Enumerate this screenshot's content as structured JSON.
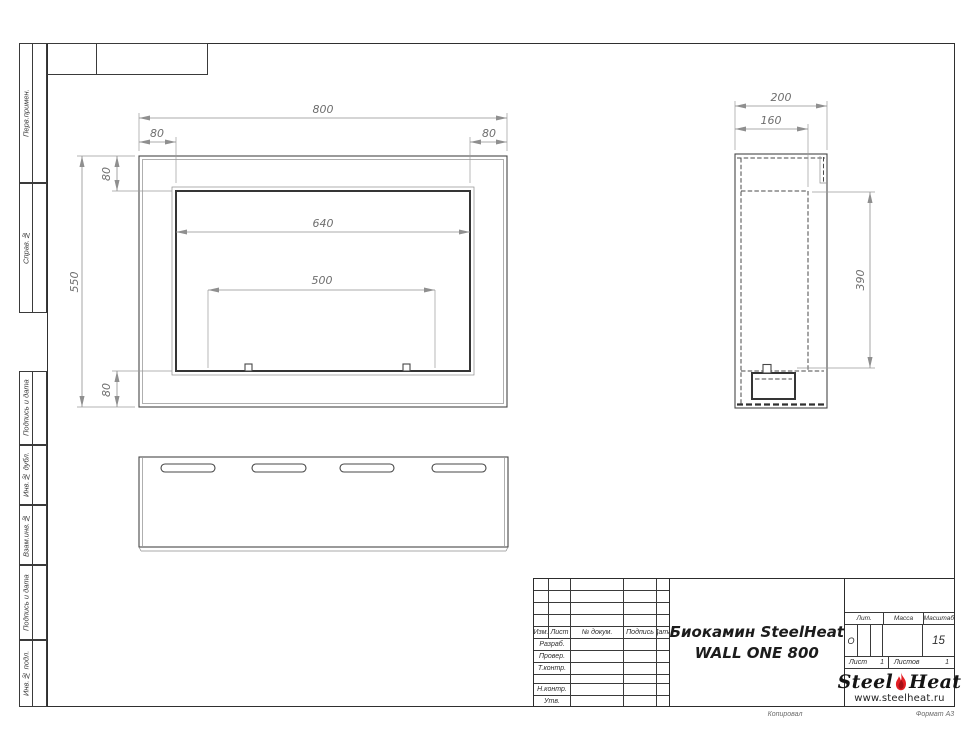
{
  "sheet": {
    "copy_label": "Копировал",
    "format_label": "Формат А3"
  },
  "left_strip": {
    "labels": [
      "Перв.примен.",
      "Справ.№",
      "Подпись и дата",
      "Инв.№ дубл.",
      "Взам.инв.№",
      "Подпись и дата",
      "Инв.№ подл."
    ]
  },
  "drawing": {
    "front": {
      "width": "800",
      "flange_left": "80",
      "flange_right": "80",
      "opening_width": "640",
      "span": "500",
      "height": "550",
      "flange_top": "80",
      "flange_bottom": "80"
    },
    "side": {
      "depth": "200",
      "inner_depth": "160",
      "opening_height": "390"
    }
  },
  "title_block": {
    "cols": {
      "izm": "Изм.",
      "list": "Лист",
      "doc": "№ докум.",
      "sign": "Подпись",
      "date": "Дата"
    },
    "rows": {
      "razrab": "Разраб.",
      "prover": "Провер.",
      "tkontr": "Т.контр.",
      "nkontr": "Н.контр.",
      "utv": "Утв."
    },
    "title_line1": "Биокамин SteelHeat",
    "title_line2": "WALL ONE 800",
    "lit_label": "Лит.",
    "lit_value": "О",
    "mass_label": "Масса",
    "scale_label": "Масштаб",
    "scale_value": "15",
    "sheet_label": "Лист",
    "sheet_value": "1",
    "sheets_label": "Листов",
    "sheets_value": "1",
    "logo": {
      "steel": "Steel",
      "heat": "Heat",
      "url": "www.steelheat.ru"
    }
  },
  "colors": {
    "flame": "#e31e24",
    "flame_dark": "#a60f16",
    "line": "#474747",
    "dim": "#8f8f8f"
  }
}
